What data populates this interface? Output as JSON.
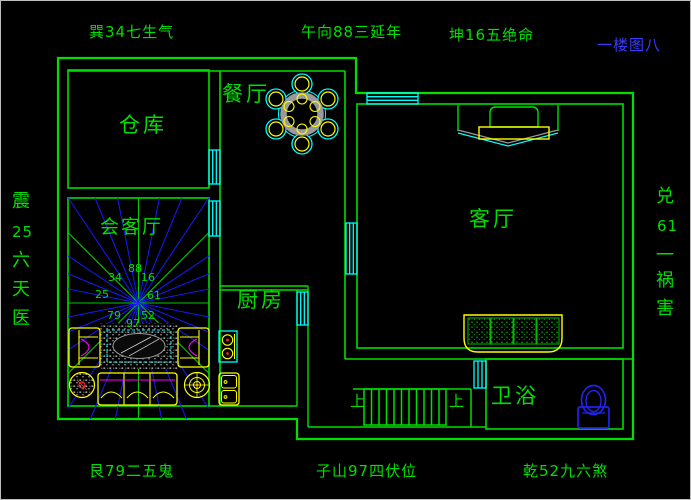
{
  "title_blue": "一楼图八",
  "perimeter_labels": {
    "top_left": "巽34七生气",
    "top_center": "午向88三延年",
    "top_right": "坤16五绝命",
    "bottom_left": "艮79二五鬼",
    "bottom_center": "子山97四伏位",
    "bottom_right": "乾52九六煞",
    "left_column": [
      "震",
      "25",
      "六",
      "天",
      "医"
    ],
    "right_column": [
      "兑",
      "61",
      "一",
      "祸",
      "害"
    ]
  },
  "rooms": {
    "storeroom": "仓库",
    "dining": "餐厅",
    "reception": "会客厅",
    "kitchen": "厨房",
    "living": "客厅",
    "bathroom": "卫浴"
  },
  "compass_numbers": {
    "se": "34",
    "s": "88",
    "sw": "16",
    "e": "25",
    "w": "61",
    "ne": "79",
    "n": "97",
    "nw": "52"
  },
  "stairs": {
    "up_left": "上",
    "up_right": "上"
  },
  "colors": {
    "wall_green": "#00df00",
    "text_green": "#00df00",
    "window_cyan": "#00ffff",
    "furniture_yellow": "#ffff00",
    "accent_magenta": "#ff00ff",
    "ray_blue": "#1717ee",
    "ray_green": "#00cc00",
    "title_blue": "#3a3aff",
    "toilet_blue": "#2222ee",
    "table_gray": "#9a9a9a",
    "dot_red": "#ff2020",
    "background": "#000000"
  }
}
